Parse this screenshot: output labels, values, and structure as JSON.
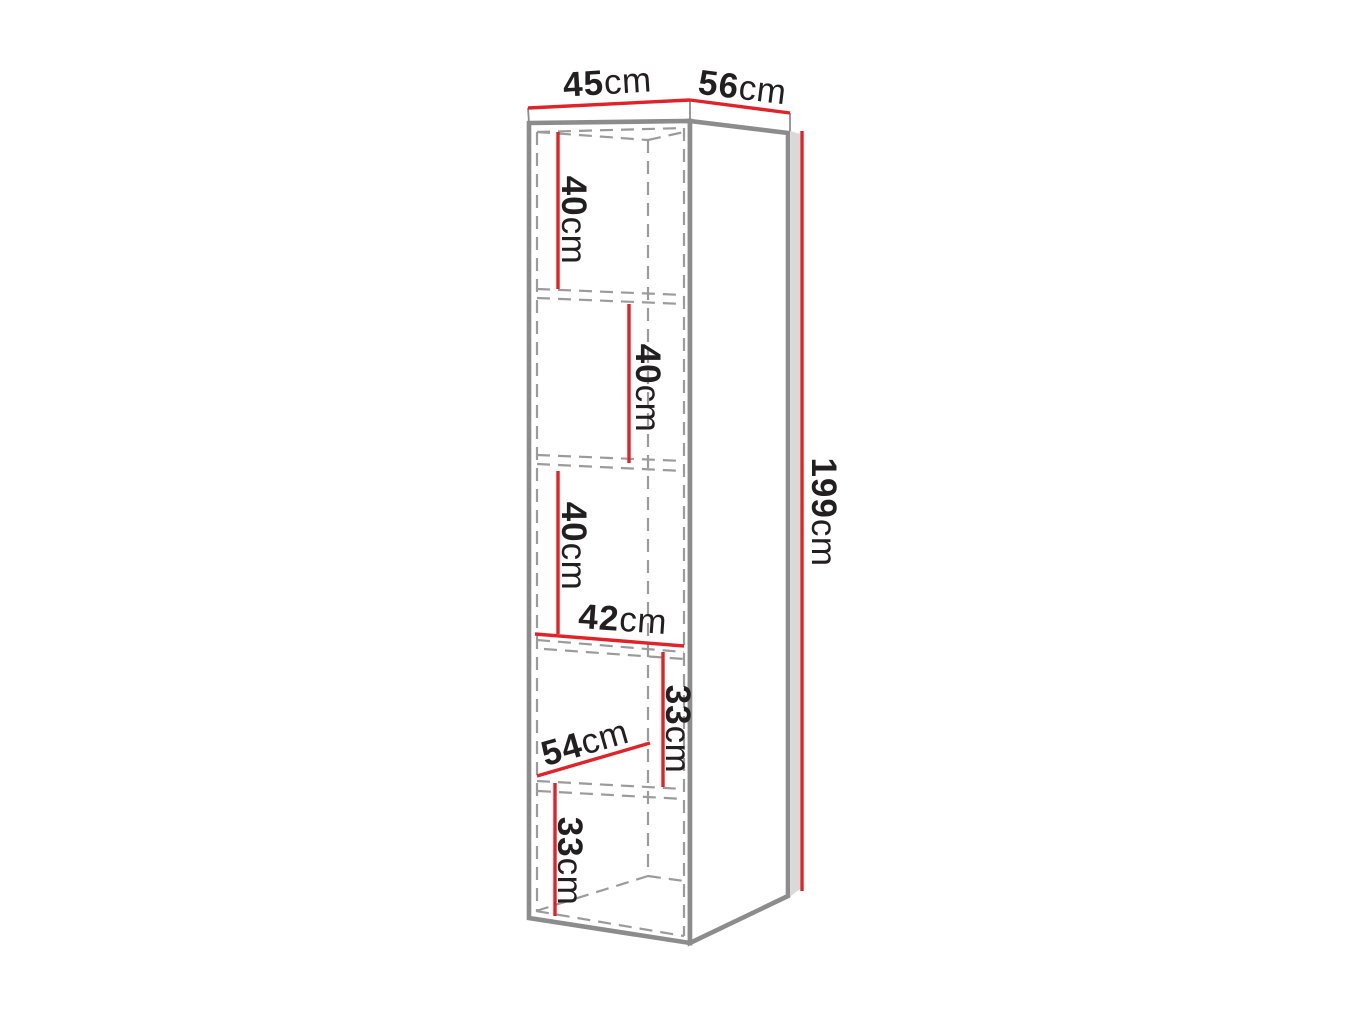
{
  "diagram": {
    "type": "furniture-dimension-diagram",
    "unit": "cm",
    "labels": {
      "top_width": {
        "num": "45",
        "unit": "cm"
      },
      "top_depth": {
        "num": "56",
        "unit": "cm"
      },
      "total_height": {
        "num": "199",
        "unit": "cm"
      },
      "shelf_1_height": {
        "num": "40",
        "unit": "cm"
      },
      "shelf_2_height": {
        "num": "40",
        "unit": "cm"
      },
      "shelf_3_height": {
        "num": "40",
        "unit": "cm"
      },
      "inner_width": {
        "num": "42",
        "unit": "cm"
      },
      "shelf_4_height": {
        "num": "33",
        "unit": "cm"
      },
      "inner_depth": {
        "num": "54",
        "unit": "cm"
      },
      "shelf_5_height": {
        "num": "33",
        "unit": "cm"
      }
    },
    "colors": {
      "background": "#ffffff",
      "dimension_red": "#e02328",
      "outline_gray": "#8c8c8c",
      "dashed_gray": "#9b9b9b",
      "panel_shade": "#d9d9d9",
      "text": "#231f20"
    }
  }
}
